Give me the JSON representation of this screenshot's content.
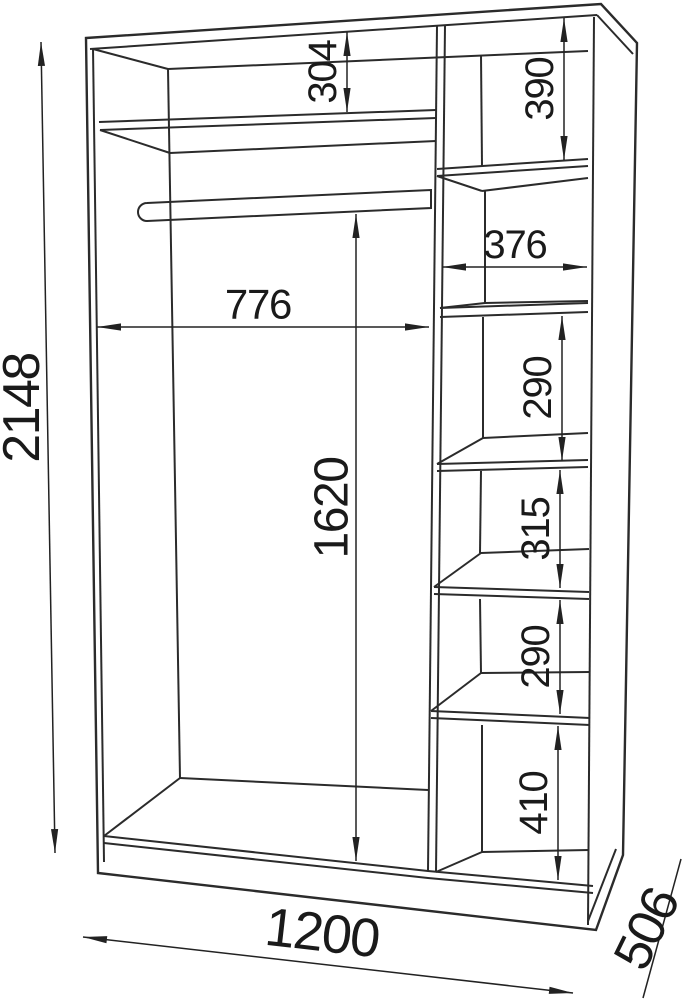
{
  "colors": {
    "line": "#2b2b2b",
    "text": "#1a1a1a",
    "background": "#ffffff"
  },
  "dims": {
    "overall_height": "2148",
    "top_shelf_drop": "304",
    "left_section_width": "776",
    "hanging_space_height": "1620",
    "overall_width": "1200",
    "depth": "506",
    "right_top_compartment": "390",
    "right_column_width": "376",
    "right_compartment_upper": "290",
    "right_compartment_middle": "315",
    "right_compartment_lower": "290",
    "right_bottom_compartment": "410"
  }
}
